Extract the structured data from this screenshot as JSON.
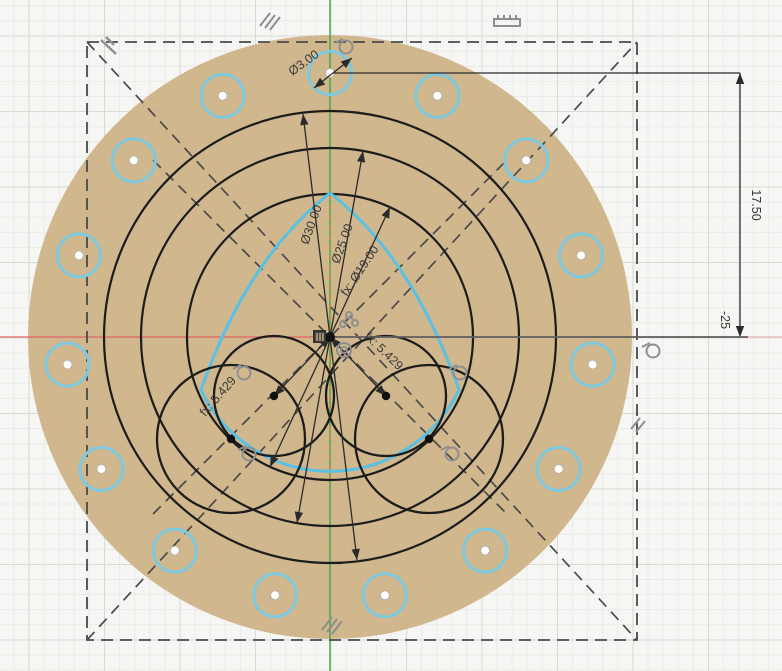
{
  "app": {
    "view_name": "cad-sketch-canvas"
  },
  "colors": {
    "background": "#f6f6f4",
    "grid_minor": "#eaeae7",
    "grid_major": "#d9d9d6",
    "profile_fill": "#cdb286",
    "sketch_line": "#1c1c1c",
    "selected_blue": "#58c1e4",
    "hole_blue": "#7fc9de",
    "construction_dash": "#4a4a4a",
    "axis_green": "#3da843",
    "axis_red": "#e06666",
    "axis_orange": "#c08a3e",
    "dim_line": "#2b2b2b",
    "dim_text": "#3a3a3a",
    "ext_gray": "#606060",
    "ext_pink": "#eec9c9",
    "icon_gray": "#8f8f8f"
  },
  "sketch": {
    "origin": {
      "x": 330,
      "y": 337
    },
    "px_per_unit": 15.09,
    "disk": {
      "r": 302
    },
    "circles": [
      {
        "id": "d30",
        "r": 226
      },
      {
        "id": "d25",
        "r": 189
      },
      {
        "id": "d19",
        "r": 143
      }
    ],
    "cluster_circles": [
      {
        "cx": 274,
        "cy": 396,
        "r": 60
      },
      {
        "cx": 386,
        "cy": 396,
        "r": 60
      },
      {
        "cx": 231,
        "cy": 439,
        "r": 74
      },
      {
        "cx": 429,
        "cy": 439,
        "r": 74
      }
    ],
    "center_points": [
      {
        "x": 330,
        "y": 337
      },
      {
        "x": 274,
        "cy": 0,
        "y": 396
      },
      {
        "x": 386,
        "y": 396
      },
      {
        "x": 231,
        "y": 439
      },
      {
        "x": 429,
        "y": 439
      }
    ],
    "bolt_pattern": {
      "count": 15,
      "pattern_r": 264,
      "hole_r": 21.5,
      "start_deg": 90,
      "step_deg": -24,
      "dot_r": 4.5
    },
    "blue_profile": {
      "apex": {
        "x": 330,
        "y": 193
      },
      "left_tangent": {
        "x": 201,
        "y": 390
      },
      "right_tangent": {
        "x": 459,
        "y": 390
      },
      "arc_r": 143
    },
    "construction_rect": {
      "x1": 87,
      "y1": 42,
      "x2": 637,
      "y2": 640
    },
    "construction_lines": [
      {
        "x1": 87,
        "y1": 42,
        "x2": 637,
        "y2": 640
      },
      {
        "x1": 87,
        "y1": 640,
        "x2": 637,
        "y2": 42
      },
      {
        "x1": 153,
        "y1": 514,
        "x2": 507,
        "y2": 160
      },
      {
        "x1": 153,
        "y1": 160,
        "x2": 507,
        "y2": 514
      }
    ],
    "dim_lines": [
      {
        "id": "dia30",
        "x1": 357,
        "y1": 560,
        "x2": 303,
        "y2": 114
      },
      {
        "id": "dia25",
        "x1": 297,
        "y1": 523,
        "x2": 363,
        "y2": 151
      },
      {
        "id": "dia19",
        "x1": 270,
        "y1": 467,
        "x2": 390,
        "y2": 207
      },
      {
        "id": "dia3",
        "x1": 314,
        "y1": 88,
        "x2": 352,
        "y2": 58
      },
      {
        "id": "r5429-left",
        "x1": 330,
        "y1": 337,
        "x2": 274,
        "y2": 396
      },
      {
        "id": "r5429-right",
        "x1": 330,
        "y1": 337,
        "x2": 386,
        "y2": 396
      },
      {
        "id": "v1750",
        "x1": 740,
        "y1": 73,
        "x2": 740,
        "y2": 337
      }
    ],
    "ext_lines": [
      {
        "x1": 334,
        "y1": 73,
        "x2": 740,
        "y2": 73,
        "stroke": "#2b2b2b",
        "w": 1.2
      },
      {
        "x1": 332,
        "y1": 337,
        "x2": 748,
        "y2": 337,
        "stroke": "#606060",
        "w": 1.8
      },
      {
        "x1": 748,
        "y1": 337,
        "x2": 782,
        "y2": 337,
        "stroke": "#eec9c9",
        "w": 2
      }
    ]
  },
  "dim_labels": [
    {
      "id": "label-d3",
      "text": "Ø3.00",
      "x": 306,
      "y": 66,
      "rot": -36
    },
    {
      "id": "label-d30",
      "text": "Ø30.00",
      "x": 315,
      "y": 226,
      "rot": -70
    },
    {
      "id": "label-d25",
      "text": "Ø25.00",
      "x": 346,
      "y": 245,
      "rot": -70
    },
    {
      "id": "label-d19",
      "text": "fx: Ø19.00",
      "x": 363,
      "y": 273,
      "rot": -56
    },
    {
      "id": "label-r5429-right",
      "text": "fx: 5.429",
      "x": 381,
      "y": 354,
      "rot": 44
    },
    {
      "id": "label-r5429-left",
      "text": "fx: 5.429",
      "x": 221,
      "y": 399,
      "rot": -49
    },
    {
      "id": "label-1750",
      "text": "17.50",
      "x": 752,
      "y": 205,
      "rot": 90
    },
    {
      "id": "label-neg25",
      "text": "-25",
      "x": 721,
      "y": 320,
      "rot": 90
    }
  ],
  "constraint_icons": [
    {
      "type": "parallel3",
      "x": 268,
      "y": 20
    },
    {
      "type": "pattern-comb",
      "x": 507,
      "y": 21
    },
    {
      "type": "perpendicular",
      "x": 108,
      "y": 46
    },
    {
      "type": "tangent",
      "x": 344,
      "y": 45
    },
    {
      "type": "tangent",
      "x": 651,
      "y": 349
    },
    {
      "type": "parallel2",
      "x": 637,
      "y": 424
    },
    {
      "type": "parallel3",
      "x": 330,
      "y": 624
    },
    {
      "type": "tangent",
      "x": 242,
      "y": 371
    },
    {
      "type": "tangent",
      "x": 247,
      "y": 452
    },
    {
      "type": "tangent",
      "x": 458,
      "y": 371
    },
    {
      "type": "tangent",
      "x": 450,
      "y": 452
    },
    {
      "type": "circular-pattern",
      "x": 348,
      "y": 320
    },
    {
      "type": "concentric",
      "x": 344,
      "y": 350
    },
    {
      "type": "lock",
      "x": 320,
      "y": 336
    }
  ]
}
